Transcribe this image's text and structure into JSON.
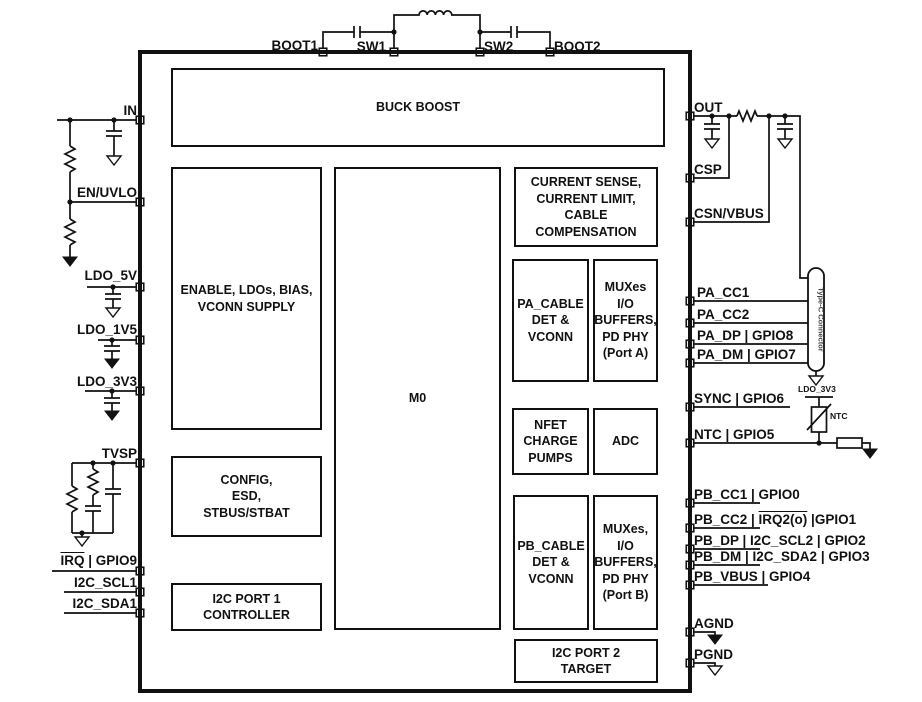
{
  "blocks": {
    "buck_boost": "BUCK BOOST",
    "enable_ldo": "ENABLE, LDOs, BIAS,\nVCONN SUPPLY",
    "m0": "M0",
    "current_sense": "CURRENT SENSE,\nCURRENT LIMIT, CABLE\nCOMPENSATION",
    "pa_cable": "PA_CABLE\nDET &\nVCONN",
    "mux_port_a": "MUXes\nI/O\nBUFFERS,\nPD PHY\n(Port A)",
    "nfet": "NFET\nCHARGE\nPUMPS",
    "adc": "ADC",
    "config": "CONFIG,\nESD,\nSTBUS/STBAT",
    "pb_cable": "PB_CABLE\nDET &\nVCONN",
    "mux_port_b": "MUXes,\nI/O\nBUFFERS,\nPD PHY\n(Port B)",
    "i2c_port1": "I2C PORT 1\nCONTROLLER",
    "i2c_port2": "I2C PORT 2\nTARGET"
  },
  "pins": {
    "top": [
      "BOOT1",
      "SW1",
      "SW2",
      "BOOT2"
    ],
    "left": {
      "in": "IN",
      "en_uvlo": "EN/UVLO",
      "ldo_5v": "LDO_5V",
      "ldo_1v5": "LDO_1V5",
      "ldo_3v3": "LDO_3V3",
      "tvsp": "TVSP",
      "irq": {
        "overlined": "IRQ",
        "rest": " | GPIO9"
      },
      "i2c_scl1": "I2C_SCL1",
      "i2c_sda1": "I2C_SDA1"
    },
    "right": {
      "out": "OUT",
      "csp": "CSP",
      "csn_vbus": "CSN/VBUS",
      "pa_cc1": "PA_CC1",
      "pa_cc2": "PA_CC2",
      "pa_dp": "PA_DP | GPIO8",
      "pa_dm": "PA_DM | GPIO7",
      "sync": "SYNC | GPIO6",
      "ntc": "NTC | GPIO5",
      "pb_cc1": "PB_CC1 | GPIO0",
      "pb_cc2": {
        "pre": "PB_CC2 | ",
        "overlined": "IRQ2(o)",
        "rest": " |GPIO1"
      },
      "pb_dp": "PB_DP | I2C_SCL2 | GPIO2",
      "pb_dm": "PB_DM | I2C_SDA2 | GPIO3",
      "pb_vbus": "PB_VBUS | GPIO4",
      "agnd": "AGND",
      "pgnd": "PGND"
    }
  },
  "external": {
    "typec_connector": "Type-C Connector",
    "ldo_3v3_rail": "LDO_3V3",
    "ntc_label": "NTC"
  },
  "colors": {
    "ink": "#111111",
    "background": "#ffffff"
  }
}
